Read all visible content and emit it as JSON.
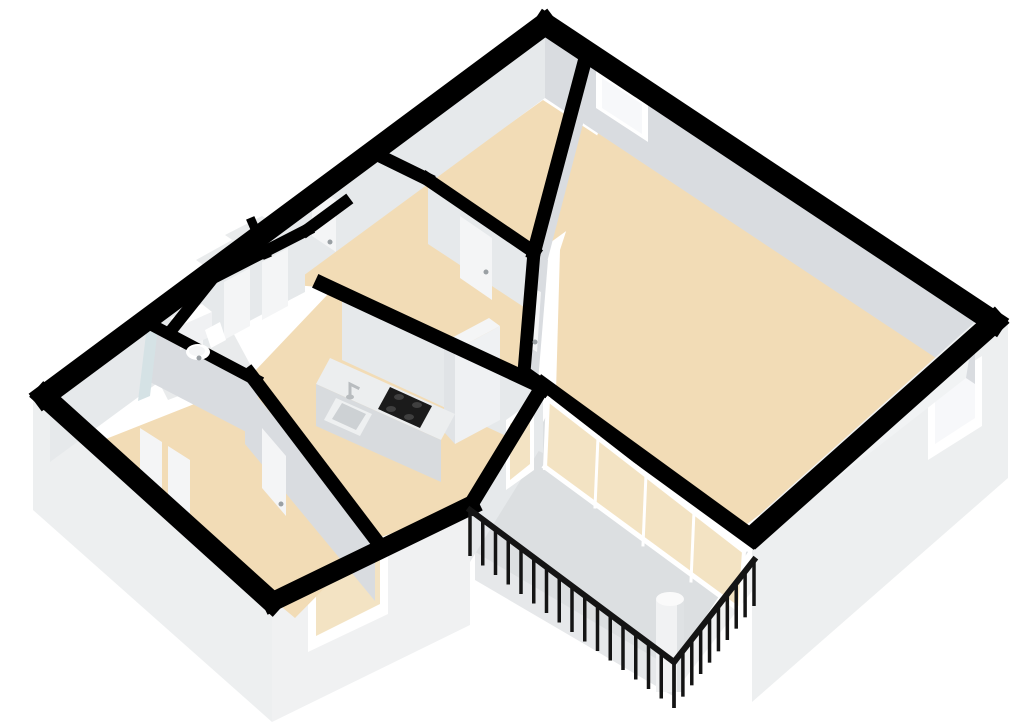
{
  "scene": {
    "width": 1024,
    "height": 724,
    "background": "#ffffff",
    "kind": "3d-floorplan-render"
  },
  "colors": {
    "bg": "#ffffff",
    "band": "#000000",
    "beige": "#f2dcb6",
    "grayFloor": "#e9ebec",
    "balconyFloor": "#dcdfe1",
    "faceSE": "#e6e9eb",
    "faceSW": "#d9dce0",
    "faceLit": "#f1f3f4",
    "ext": "#edeff0",
    "extLight": "#f0f1f2",
    "extShade": "#e6e8ea",
    "white": "#ffffff",
    "offWhite": "#f4f5f6",
    "glassTint": "#f3e3c3",
    "glassPale": "#f7f8fa",
    "dark": "#1b1b1b",
    "burner": "#3f3f3f",
    "metal": "#b8bcbf",
    "railing": "#141414",
    "panel": "#f0f1f3",
    "handle": "#9aa0a4",
    "shower": "#d5e2e5",
    "colTop": "#fafafa",
    "colBody": "#f1f2f3",
    "colShade": "#dfe2e4",
    "cabFront": "#eff1f3",
    "cabSide": "#e0e3e6",
    "cabTop": "#f4f5f6",
    "counterTop": "#eceeef",
    "counterFront": "#d8dbde",
    "sinkBasin": "#cdd1d4",
    "sinkRim": "#eef0f1"
  },
  "polygons": [
    {
      "name": "exterior-face-southwest",
      "fill": "ext",
      "pts": "33,395 272,607 272,722 33,510"
    },
    {
      "name": "exterior-face-seblock",
      "fill": "extLight",
      "pts": "272,607 470,510 470,625 272,722"
    },
    {
      "name": "bed1-window-frame",
      "fill": "white",
      "pts": "308,570 388,532 388,614 308,652"
    },
    {
      "name": "bed1-window-glass",
      "fill": "glassTint",
      "pts": "316,578 380,546 380,604 316,636"
    },
    {
      "name": "exterior-face-southeast",
      "fill": "ext",
      "pts": "752,548 1008,324 1008,478 752,702"
    },
    {
      "name": "se-window-frame",
      "fill": "white",
      "pts": "928,390 982,356 982,426 928,460"
    },
    {
      "name": "se-window-glass",
      "fill": "glassPale",
      "pts": "935,396 975,370 975,418 935,444"
    },
    {
      "name": "balcony-slab-face-sw",
      "fill": "extShade",
      "pts": "475,552 673,668 673,696 475,580"
    },
    {
      "name": "balcony-slab-face-se",
      "fill": "extLight",
      "pts": "673,668 756,560 756,586 673,694"
    },
    {
      "name": "floor-bedroom2",
      "fill": "beige",
      "pts": "543,100 650,170 536,253 428,182"
    },
    {
      "name": "floor-living-room",
      "fill": "beige",
      "pts": "598,133 952,367 742,528 556,392 560,250"
    },
    {
      "name": "floor-hall",
      "fill": "beige",
      "pts": "310,232 428,182 536,253 524,372 330,288 213,278"
    },
    {
      "name": "floor-kitchen",
      "fill": "beige",
      "pts": "330,292 540,388 468,508 372,540 253,373"
    },
    {
      "name": "floor-bedroom1",
      "fill": "beige",
      "pts": "250,382 372,540 295,618 88,446"
    },
    {
      "name": "floor-bathroom",
      "fill": "grayFloor",
      "pts": "130,325 208,286 252,368 168,400"
    },
    {
      "name": "floor-closet-1",
      "fill": "grayFloor",
      "pts": "225,235 262,216 288,232 250,252"
    },
    {
      "name": "floor-closet-2",
      "fill": "grayFloor",
      "pts": "196,260 232,240 258,258 222,278"
    },
    {
      "name": "floor-balcony",
      "fill": "balconyFloor",
      "pts": "553,403 748,552 672,668 475,552"
    },
    {
      "name": "wall-face-nw-inner",
      "fill": "faceSE",
      "pts": "545,36 50,400 50,462 545,98"
    },
    {
      "name": "entry-door-panel",
      "fill": "offWhite",
      "pts": "312,184 336,200 336,252 312,236"
    },
    {
      "name": "bed1-wardrobe-door-1",
      "fill": "offWhite",
      "pts": "140,428 162,442 162,500 140,486"
    },
    {
      "name": "bed1-wardrobe-door-2",
      "fill": "offWhite",
      "pts": "168,446 190,460 190,514 168,500"
    },
    {
      "name": "wall-face-ne-inner",
      "fill": "faceSW",
      "pts": "545,36 975,322 975,384 545,98"
    },
    {
      "name": "ne-window-frame",
      "fill": "white",
      "pts": "596,70 648,104 648,142 596,108"
    },
    {
      "name": "ne-window-glass",
      "fill": "glassPale",
      "pts": "602,78 642,104 642,134 602,108"
    },
    {
      "name": "wall-face-se-inner",
      "fill": "faceLit",
      "pts": "975,322 760,514 752,545 966,378"
    },
    {
      "name": "wall-face-bed2-se",
      "fill": "faceSW",
      "pts": "583,66 534,254 534,312 583,124"
    },
    {
      "name": "wall-face-hall-living",
      "fill": "faceSW",
      "pts": "534,252 522,372 538,382 548,260"
    },
    {
      "name": "hall-living-door-panel",
      "fill": "offWhite",
      "pts": "527,286 541,292 537,352 524,344"
    },
    {
      "name": "wall-face-bed2-sw",
      "fill": "faceSE",
      "pts": "536,253 428,182 428,244 536,315"
    },
    {
      "name": "bed2-door-panel",
      "fill": "offWhite",
      "pts": "460,216 492,238 492,300 460,278"
    },
    {
      "name": "wall-face-closets-front",
      "fill": "faceSE",
      "pts": "213,284 305,236 305,292 213,340"
    },
    {
      "name": "closet-door-1",
      "fill": "offWhite",
      "pts": "262,262 288,248 288,306 262,320"
    },
    {
      "name": "closet-door-2",
      "fill": "offWhite",
      "pts": "224,282 250,268 250,326 224,340"
    },
    {
      "name": "wall-face-bath-front",
      "fill": "faceSE",
      "pts": "172,336 213,284 213,340 172,392"
    },
    {
      "name": "bath-door-panel",
      "fill": "offWhite",
      "pts": "180,330 203,308 203,364 180,386"
    },
    {
      "name": "wall-face-bath-south",
      "fill": "faceSW",
      "pts": "150,328 258,384 258,438 150,382"
    },
    {
      "name": "wall-face-kitchen-back",
      "fill": "faceSE",
      "pts": "342,300 543,393 543,453 342,360"
    },
    {
      "name": "wall-face-bed1-ne",
      "fill": "faceSW",
      "pts": "245,382 375,539 375,601 245,444"
    },
    {
      "name": "bed1-door-panel",
      "fill": "offWhite",
      "pts": "262,428 286,456 286,516 262,488"
    },
    {
      "name": "wall-face-balcony-nw",
      "fill": "faceSE",
      "pts": "543,390 470,508 470,562 543,444"
    },
    {
      "name": "balcony-door-frame",
      "fill": "white",
      "pts": "506,420 534,400 534,470 506,490"
    },
    {
      "name": "balcony-door-glass",
      "fill": "glassTint",
      "pts": "510,424 530,408 530,464 510,480"
    },
    {
      "name": "sliding-wall-glass",
      "fill": "glassTint",
      "pts": "548,398 744,550 740,612 545,468"
    },
    {
      "name": "kitchen-cabinet-top",
      "fill": "cabTop",
      "pts": "444,342 455,350 500,326 489,318"
    },
    {
      "name": "kitchen-cabinet-front",
      "fill": "cabFront",
      "pts": "455,350 500,326 500,420 455,444"
    },
    {
      "name": "kitchen-cabinet-side",
      "fill": "cabSide",
      "pts": "444,342 455,350 455,444 444,432"
    },
    {
      "name": "kitchen-counter-top",
      "fill": "counterTop",
      "pts": "330,358 455,414 441,440 316,384"
    },
    {
      "name": "kitchen-counter-front",
      "fill": "counterFront",
      "pts": "316,384 441,440 441,482 316,426"
    },
    {
      "name": "kitchen-hob",
      "fill": "dark",
      "pts": "390,387 432,406 420,428 378,409"
    },
    {
      "name": "kitchen-sink-rim",
      "fill": "sinkRim",
      "pts": "336,398 372,414 360,436 324,420"
    },
    {
      "name": "kitchen-sink-basin",
      "fill": "sinkBasin",
      "pts": "342,403 366,414 356,430 332,419"
    },
    {
      "name": "bath-vanity-top",
      "fill": "white",
      "pts": "170,318 202,304 212,312 180,326"
    },
    {
      "name": "bath-vanity-front",
      "fill": "panel",
      "pts": "180,326 212,312 212,336 180,350"
    },
    {
      "name": "toilet-tank",
      "fill": "white",
      "pts": "205,330 220,322 226,340 211,348"
    },
    {
      "name": "shower-glass-panel",
      "fill": "shower",
      "pts": "146,334 158,327 150,396 138,401"
    },
    {
      "name": "balcony-column-body",
      "fill": "colBody",
      "pts": "656,600 684,600 684,692 656,692"
    },
    {
      "name": "balcony-column-shade",
      "fill": "colShade",
      "pts": "677,600 684,600 684,692 677,692"
    }
  ],
  "lines": [
    {
      "name": "wall-band-nw",
      "color": "band",
      "w": 22,
      "pts": "545,24 44,396"
    },
    {
      "name": "wall-band-ne",
      "color": "band",
      "w": 22,
      "pts": "545,24 994,322"
    },
    {
      "name": "wall-band-se",
      "color": "band",
      "w": 22,
      "pts": "994,322 756,534"
    },
    {
      "name": "wall-band-sw",
      "color": "band",
      "w": 21,
      "pts": "44,396 272,602"
    },
    {
      "name": "wall-band-seblock",
      "color": "band",
      "w": 19,
      "pts": "272,602 470,506"
    },
    {
      "name": "wall-band-balcony-nw",
      "color": "band",
      "w": 15,
      "pts": "470,506 543,386"
    },
    {
      "name": "wall-band-sliding",
      "color": "band",
      "w": 17,
      "pts": "543,386 752,538"
    },
    {
      "name": "wall-band-bed2-se",
      "color": "band",
      "w": 14,
      "pts": "584,64 534,252"
    },
    {
      "name": "wall-band-bed2-sw",
      "color": "band",
      "w": 13,
      "pts": "534,252 427,179"
    },
    {
      "name": "wall-band-bed2-w",
      "color": "band",
      "w": 13,
      "pts": "427,179 380,156"
    },
    {
      "name": "wall-band-hall-living",
      "color": "band",
      "w": 13,
      "pts": "534,252 524,372 545,387"
    },
    {
      "name": "wall-band-kitchen-back",
      "color": "band",
      "w": 15,
      "pts": "322,284 543,387"
    },
    {
      "name": "wall-band-bed1-ne",
      "color": "band",
      "w": 14,
      "pts": "250,374 376,540"
    },
    {
      "name": "wall-band-closets-front",
      "color": "band",
      "w": 12,
      "pts": "213,278 307,230"
    },
    {
      "name": "wall-band-closet-divider",
      "color": "band",
      "w": 9,
      "pts": "252,222 266,254"
    },
    {
      "name": "wall-band-closets-top",
      "color": "band",
      "w": 12,
      "pts": "307,230 345,202"
    },
    {
      "name": "wall-band-bath-front",
      "color": "band",
      "w": 12,
      "pts": "213,278 170,332"
    },
    {
      "name": "wall-band-bath-south",
      "color": "band",
      "w": 12,
      "pts": "150,324 256,380"
    },
    {
      "name": "sliding-frame-top",
      "color": "white",
      "w": 5,
      "pts": "548,399 744,551"
    },
    {
      "name": "sliding-frame-bottom",
      "color": "white",
      "w": 5,
      "pts": "545,467 741,611"
    },
    {
      "name": "sliding-frame-start",
      "color": "white",
      "w": 4,
      "pts": "548,399 545,468"
    },
    {
      "name": "sliding-frame-end",
      "color": "white",
      "w": 4,
      "pts": "744,551 740,611"
    },
    {
      "name": "sliding-mullion-1",
      "color": "white",
      "w": 3,
      "pts": "598,437 595,507"
    },
    {
      "name": "sliding-mullion-2",
      "color": "white",
      "w": 3,
      "pts": "646,474 643,545"
    },
    {
      "name": "sliding-mullion-3",
      "color": "white",
      "w": 3,
      "pts": "694,511 691,581"
    },
    {
      "name": "kitchen-faucet",
      "color": "metal",
      "w": 3,
      "pts": "350,396 350,384 358,388"
    }
  ],
  "ellipses": [
    {
      "name": "balcony-column-top",
      "fill": "colTop",
      "cx": 670,
      "cy": 599,
      "rx": 14,
      "ry": 7
    },
    {
      "name": "toilet-bowl",
      "fill": "white",
      "cx": 198,
      "cy": 352,
      "rx": 12,
      "ry": 8
    },
    {
      "name": "toilet-seat",
      "fill": "offWhite",
      "cx": 197,
      "cy": 351,
      "rx": 8,
      "ry": 5
    },
    {
      "name": "hob-burner-1",
      "fill": "burner",
      "cx": 399,
      "cy": 397,
      "rx": 5,
      "ry": 3
    },
    {
      "name": "hob-burner-2",
      "fill": "burner",
      "cx": 417,
      "cy": 405,
      "rx": 5,
      "ry": 3
    },
    {
      "name": "hob-burner-3",
      "fill": "burner",
      "cx": 391,
      "cy": 409,
      "rx": 5,
      "ry": 3
    },
    {
      "name": "hob-burner-4",
      "fill": "burner",
      "cx": 409,
      "cy": 417,
      "rx": 5,
      "ry": 3
    },
    {
      "name": "kitchen-faucet-base",
      "fill": "metal",
      "cx": 350,
      "cy": 397,
      "rx": 4,
      "ry": 2.5
    },
    {
      "name": "bed2-door-handle",
      "fill": "handle",
      "cx": 486,
      "cy": 272,
      "rx": 2.5,
      "ry": 2.5
    },
    {
      "name": "hall-living-door-handle",
      "fill": "handle",
      "cx": 535,
      "cy": 342,
      "rx": 2.5,
      "ry": 2.5
    },
    {
      "name": "bed1-door-handle",
      "fill": "handle",
      "cx": 281,
      "cy": 504,
      "rx": 2.5,
      "ry": 2.5
    },
    {
      "name": "entry-door-handle",
      "fill": "handle",
      "cx": 330,
      "cy": 242,
      "rx": 2.5,
      "ry": 2.5
    },
    {
      "name": "bath-door-handle",
      "fill": "handle",
      "cx": 199,
      "cy": 358,
      "rx": 2.5,
      "ry": 2.5
    }
  ],
  "railing": {
    "color": "railing",
    "rail_width": 6,
    "post_width": 3.5,
    "post_drop": 46,
    "runs": [
      {
        "name": "balcony-railing-sw",
        "x1": 470,
        "y1": 510,
        "x2": 674,
        "y2": 662,
        "posts": 16
      },
      {
        "name": "balcony-railing-se",
        "x1": 674,
        "y1": 662,
        "x2": 754,
        "y2": 560,
        "posts": 9
      }
    ]
  }
}
